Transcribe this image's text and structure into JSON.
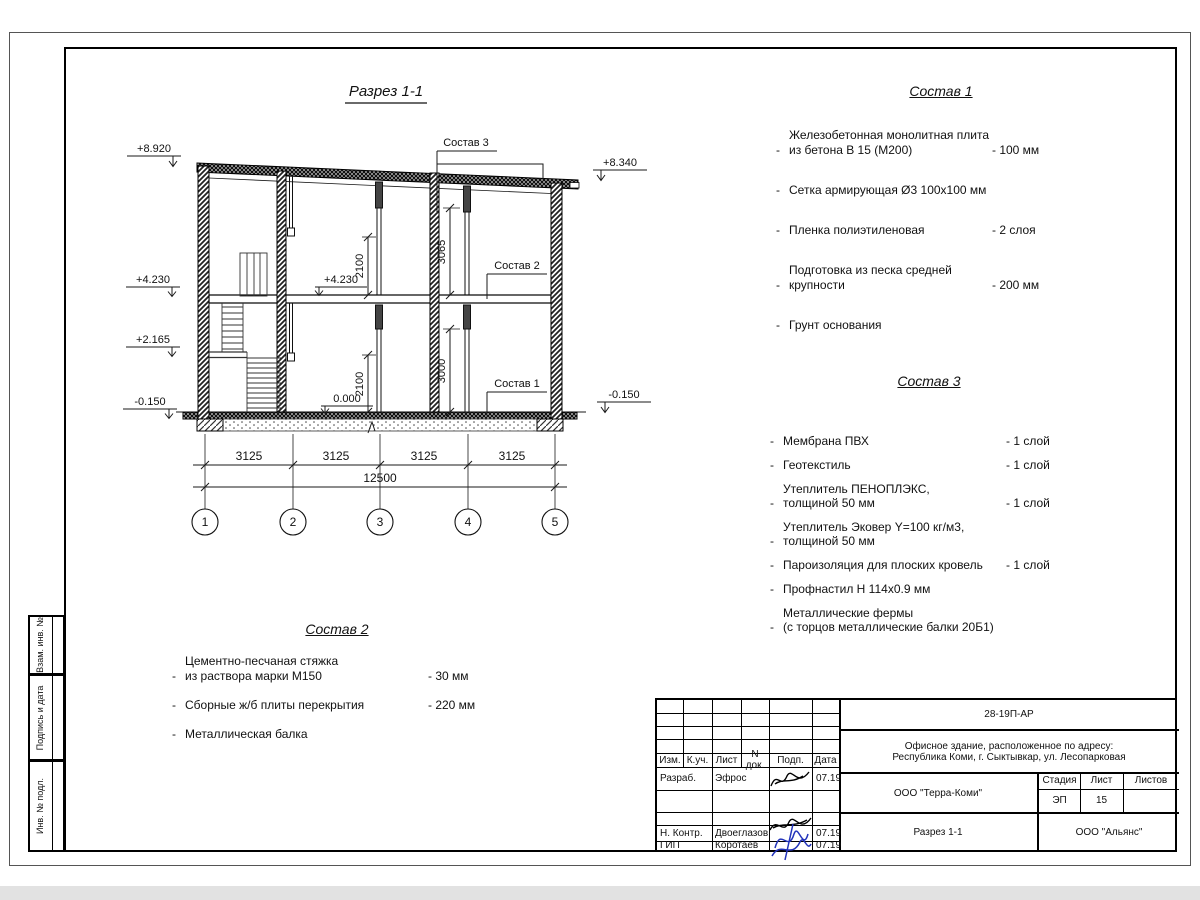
{
  "ui": {
    "bullet": "-"
  },
  "drawing": {
    "title": "Разрез 1-1",
    "marks": {
      "m8920": "+8.920",
      "m8340": "+8.340",
      "m4230l": "+4.230",
      "m2165": "+2.165",
      "m015l": "-0.150",
      "m015r": "-0.150",
      "m4230i": "+4.230",
      "m0000": "0.000"
    },
    "dims": {
      "d2100a": "2100",
      "d2100b": "2100",
      "d3065": "3065",
      "d3000": "3000",
      "s1": "3125",
      "s2": "3125",
      "s3": "3125",
      "s4": "3125",
      "total": "12500"
    },
    "leaders": {
      "c1": "Состав 1",
      "c2": "Состав 2",
      "c3": "Состав 3"
    },
    "axes": [
      "1",
      "2",
      "3",
      "4",
      "5"
    ]
  },
  "comp1": {
    "title": "Состав 1",
    "items": [
      {
        "name": "Железобетонная  монолитная плита\nиз бетона В 15 (М200)",
        "value": "- 100 мм"
      },
      {
        "name": "Сетка армирующая Ø3 100х100 мм",
        "value": ""
      },
      {
        "name": "Пленка полиэтиленовая",
        "value": "-  2 слоя"
      },
      {
        "name": "Подготовка из песка средней\nкрупности",
        "value": "- 200 мм"
      },
      {
        "name": "Грунт основания",
        "value": ""
      }
    ]
  },
  "comp2": {
    "title": "Состав 2",
    "items": [
      {
        "name": "Цементно-песчаная стяжка\nиз раствора марки М150",
        "value": "- 30 мм"
      },
      {
        "name": "Сборные ж/б плиты перекрытия",
        "value": "- 220 мм"
      },
      {
        "name": "Металлическая балка",
        "value": ""
      }
    ]
  },
  "comp3": {
    "title": "Состав 3",
    "items": [
      {
        "name": "Мембрана ПВХ",
        "value": "- 1 слой"
      },
      {
        "name": "Геотекстиль",
        "value": "- 1 слой"
      },
      {
        "name": "Утеплитель ПЕНОПЛЭКС,\nтолщиной 50 мм",
        "value": "- 1 слой"
      },
      {
        "name": "Утеплитель Эковер Y=100 кг/м3,\nтолщиной 50 мм",
        "value": "- 3 слоя"
      },
      {
        "name": "Пароизоляция для плоских кровель",
        "value": "- 1 слой"
      },
      {
        "name": "Профнастил Н 114х0.9 мм",
        "value": ""
      },
      {
        "name": "Металлические фермы\n(с торцов металлические балки 20Б1)",
        "value": ""
      }
    ]
  },
  "titleblock": {
    "doc_number": "28-19П-АР",
    "object_line1": "Офисное здание, расположенное по адресу:",
    "object_line2": "Республика Коми, г. Сыктывкар, ул. Лесопарковая",
    "cols": {
      "izm": "Изм.",
      "kuch": "К.уч.",
      "list": "Лист",
      "ndok": "N док.",
      "podp": "Подп.",
      "data": "Дата"
    },
    "rows": {
      "razrab_label": "Разраб.",
      "razrab_name": "Эфрос",
      "razrab_date": "07.19",
      "nkontr_label": "Н. Контр.",
      "nkontr_name": "Двоеглазов",
      "nkontr_date": "07.19",
      "gip_label": "ГИП",
      "gip_name": "Коротаев",
      "gip_date": "07.19"
    },
    "org": "ООО \"Терра-Коми\"",
    "stage_label": "Стадия",
    "sheet_label": "Лист",
    "sheets_label": "Листов",
    "stage": "ЭП",
    "sheet": "15",
    "drawing_name": "Разрез 1-1",
    "contractor": "ООО \"Альянс\""
  },
  "side": {
    "vzam": "Взам. инв. №",
    "podpis": "Подпись и дата",
    "inv": "Инв. № подл."
  }
}
